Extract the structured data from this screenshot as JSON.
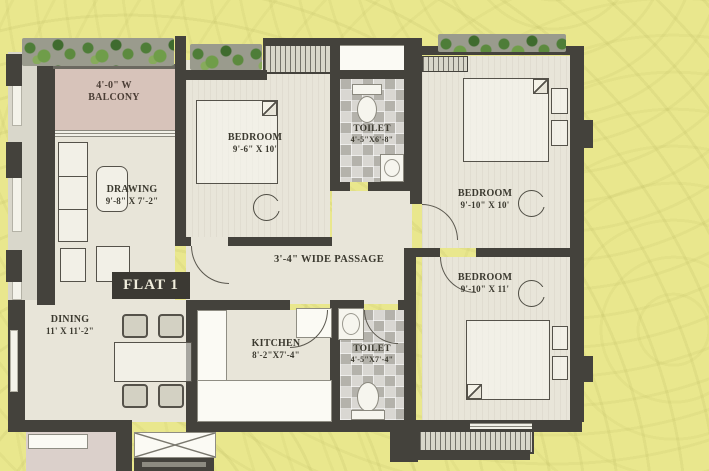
{
  "labels": {
    "flat_badge": "FLAT 1",
    "balcony_width": "4'-0\" W",
    "balcony_name": "BALCONY",
    "drawing_name": "DRAWING",
    "drawing_dims": "9'-8\" X 7'-2\"",
    "dining_name": "DINING",
    "dining_dims": "11' X 11'-2\"",
    "kitchen_name": "KITCHEN",
    "kitchen_dims": "8'-2\"X7'-4\"",
    "bedroom_top_name": "BEDROOM",
    "bedroom_top_dims": "9'-6\" X 10'",
    "bedroom_right_name": "BEDROOM",
    "bedroom_right_dims": "9'-10\" X 10'",
    "bedroom_bottom_name": "BEDROOM",
    "bedroom_bottom_dims": "9'-10\" X 11'",
    "toilet_top_name": "TOILET",
    "toilet_top_dims": "4'-5\"X6'-8\"",
    "toilet_bottom_name": "TOILET",
    "toilet_bottom_dims": "4'-5\"X7'-4\"",
    "passage": "3'-4\" WIDE PASSAGE"
  },
  "colors": {
    "background": "#e9e78d",
    "wall": "#44423c",
    "floor": "#e8e5d9",
    "balcony_floor": "#d7c3ba",
    "tile": "#c8c6be",
    "badge_bg": "#3b3933",
    "badge_text": "#f1eedd",
    "plant_green": "#5c8a3e"
  }
}
